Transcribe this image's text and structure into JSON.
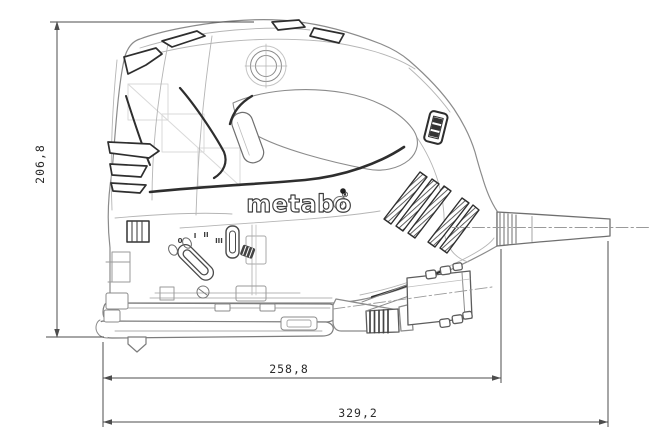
{
  "logo": {
    "text": "metabo",
    "registered": "®"
  },
  "dimensions": {
    "height": "206,8",
    "body_length": "258,8",
    "total_length": "329,2"
  },
  "dial": {
    "marks": [
      "0",
      "I",
      "II",
      "III"
    ]
  },
  "colors": {
    "background": "#ffffff",
    "outline": "#8b8b8b",
    "accent_dark": "#2e2e2e",
    "dimension_line": "#4d4d4d",
    "label_text": "#2b2b2b"
  }
}
